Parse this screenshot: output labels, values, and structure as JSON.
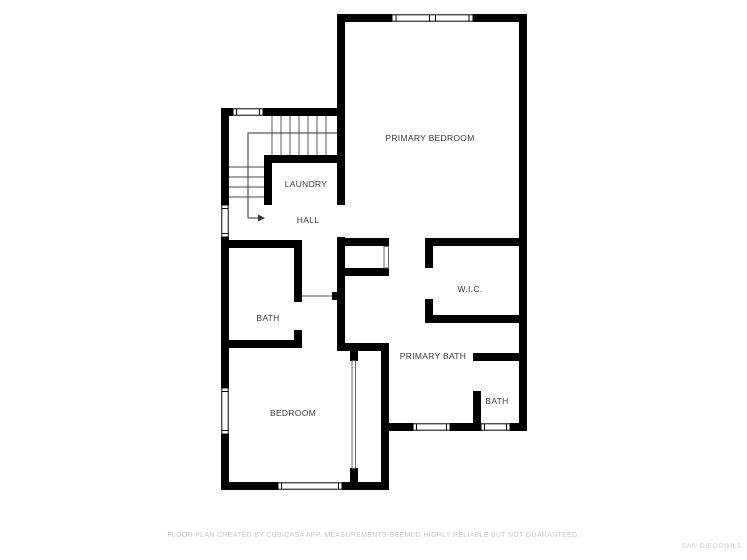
{
  "plan": {
    "rooms": [
      {
        "id": "primary-bedroom",
        "label": "PRIMARY BEDROOM"
      },
      {
        "id": "laundry",
        "label": "LAUNDRY"
      },
      {
        "id": "hall",
        "label": "HALL"
      },
      {
        "id": "wic",
        "label": "W.I.C."
      },
      {
        "id": "bath",
        "label": "BATH"
      },
      {
        "id": "primary-bath",
        "label": "PRIMARY BATH"
      },
      {
        "id": "bath-2",
        "label": "BATH"
      },
      {
        "id": "bedroom",
        "label": "BEDROOM"
      }
    ],
    "icons": {
      "stairs_direction": "arrow-right"
    }
  },
  "footer": {
    "disclaimer": "FLOOR PLAN CREATED BY CUBICASA APP. MEASUREMENTS DEEMED HIGHLY RELIABLE BUT NOT GUARANTEED.",
    "watermark": "SAN DIEGO|MLS"
  },
  "colors": {
    "wall": "#000000",
    "background": "#ffffff",
    "label": "#3a3a3a",
    "stair_line": "#4a4a4a",
    "disclaimer": "#c9c9c9",
    "watermark": "#d2d2d2"
  }
}
